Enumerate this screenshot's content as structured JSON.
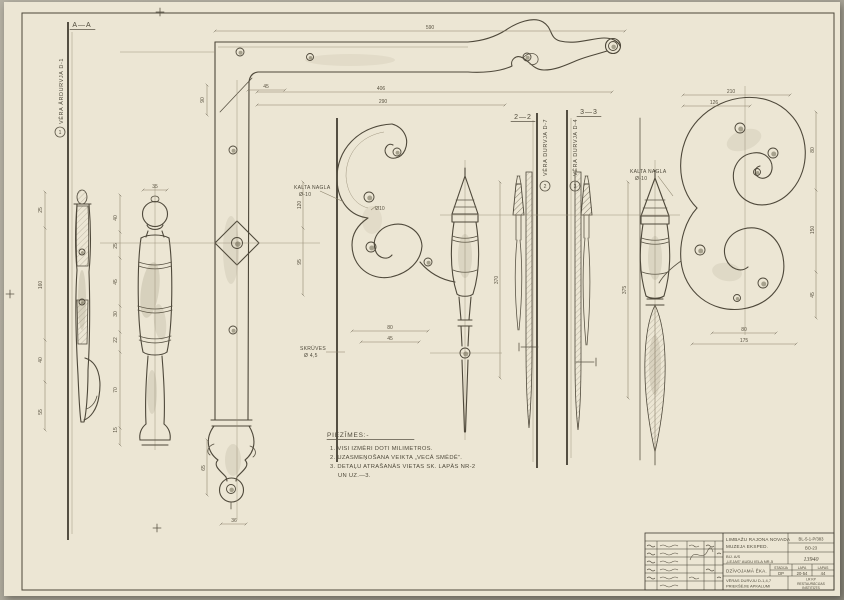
{
  "colors": {
    "paper": "#ece6d4",
    "background": "#a9a598",
    "pencil": "#4e483a",
    "pencil_light": "#8a8069"
  },
  "section_labels": {
    "left": "A—A",
    "mid": "2—2",
    "right": "3—3"
  },
  "vertical_labels": [
    {
      "no": "1",
      "text": "VĒRA ĀRDURVJA D-1"
    },
    {
      "no": "2",
      "text": "VĒRA DURVJA D-7"
    },
    {
      "no": "3",
      "text": "VĒRA DURVJA D-4"
    }
  ],
  "annotations": {
    "nail1_l1": "KALTA NAGLA",
    "nail1_l2": "Ø-10",
    "nail2_l1": "KALTA NAGLA",
    "nail2_l2": "Ø-10",
    "screws_l1": "SKRŪVES",
    "screws_l2": "Ø 4,5"
  },
  "notes": {
    "title": "PIEZĪMES:-",
    "lines": [
      "1. VISI IZMĒRI DOTI MILIMETROS.",
      "2. UZASMEŅOŠANA VEIKTA „VECĀ SMĒDĒ”.",
      "3. DETAĻU ATRAŠANĀS VIETAS SK. LAPĀS NR-2",
      "UN UZ.—3."
    ]
  },
  "dimensions": [
    {
      "v": "590",
      "x": 430,
      "y": 29,
      "r": 0
    },
    {
      "v": "406",
      "x": 381,
      "y": 90,
      "r": 0
    },
    {
      "v": "290",
      "x": 383,
      "y": 103,
      "r": 0
    },
    {
      "v": "45",
      "x": 266,
      "y": 88,
      "r": 0
    },
    {
      "v": "90",
      "x": 204,
      "y": 100,
      "r": -90
    },
    {
      "v": "210",
      "x": 731,
      "y": 93,
      "r": 0
    },
    {
      "v": "126",
      "x": 714,
      "y": 104,
      "r": 0
    },
    {
      "v": "80",
      "x": 814,
      "y": 150,
      "r": -90
    },
    {
      "v": "150",
      "x": 814,
      "y": 230,
      "r": -90
    },
    {
      "v": "45",
      "x": 814,
      "y": 295,
      "r": -90
    },
    {
      "v": "80",
      "x": 744,
      "y": 331,
      "r": 0
    },
    {
      "v": "175",
      "x": 744,
      "y": 342,
      "r": 0
    },
    {
      "v": "35",
      "x": 155,
      "y": 188,
      "r": 0
    },
    {
      "v": "40",
      "x": 117,
      "y": 218,
      "r": -90
    },
    {
      "v": "25",
      "x": 117,
      "y": 246,
      "r": -90
    },
    {
      "v": "45",
      "x": 117,
      "y": 282,
      "r": -90
    },
    {
      "v": "30",
      "x": 117,
      "y": 314,
      "r": -90
    },
    {
      "v": "22",
      "x": 117,
      "y": 340,
      "r": -90
    },
    {
      "v": "70",
      "x": 117,
      "y": 390,
      "r": -90
    },
    {
      "v": "15",
      "x": 117,
      "y": 430,
      "r": -90
    },
    {
      "v": "25",
      "x": 42,
      "y": 210,
      "r": -90
    },
    {
      "v": "160",
      "x": 42,
      "y": 285,
      "r": -90
    },
    {
      "v": "40",
      "x": 42,
      "y": 360,
      "r": -90
    },
    {
      "v": "55",
      "x": 42,
      "y": 412,
      "r": -90
    },
    {
      "v": "120",
      "x": 301,
      "y": 205,
      "r": -90
    },
    {
      "v": "95",
      "x": 301,
      "y": 262,
      "r": -90
    },
    {
      "v": "80",
      "x": 390,
      "y": 329,
      "r": 0
    },
    {
      "v": "45",
      "x": 390,
      "y": 340,
      "r": 0
    },
    {
      "v": "370",
      "x": 498,
      "y": 280,
      "r": -90
    },
    {
      "v": "375",
      "x": 626,
      "y": 290,
      "r": -90
    },
    {
      "v": "Ø10",
      "x": 380,
      "y": 210,
      "r": 0
    },
    {
      "v": "36",
      "x": 234,
      "y": 522,
      "r": 0
    },
    {
      "v": "65",
      "x": 205,
      "y": 468,
      "r": -90
    }
  ],
  "rivets": [
    {
      "x": 240,
      "y": 52,
      "r": 4
    },
    {
      "x": 310,
      "y": 57,
      "r": 3.5
    },
    {
      "x": 527,
      "y": 57,
      "r": 4
    },
    {
      "x": 613,
      "y": 46,
      "r": 4.5
    },
    {
      "x": 233,
      "y": 150,
      "r": 4
    },
    {
      "x": 233,
      "y": 330,
      "r": 4
    },
    {
      "x": 231,
      "y": 489,
      "r": 4.5
    },
    {
      "x": 237,
      "y": 243,
      "r": 5.5
    },
    {
      "x": 397,
      "y": 152,
      "r": 4
    },
    {
      "x": 369,
      "y": 197,
      "r": 5
    },
    {
      "x": 371,
      "y": 247,
      "r": 5
    },
    {
      "x": 428,
      "y": 262,
      "r": 4
    },
    {
      "x": 465,
      "y": 353,
      "r": 5
    },
    {
      "x": 740,
      "y": 128,
      "r": 5
    },
    {
      "x": 773,
      "y": 153,
      "r": 5
    },
    {
      "x": 757,
      "y": 172,
      "r": 3.5
    },
    {
      "x": 700,
      "y": 250,
      "r": 5
    },
    {
      "x": 763,
      "y": 283,
      "r": 5
    },
    {
      "x": 737,
      "y": 298,
      "r": 3.5
    },
    {
      "x": 82,
      "y": 252,
      "r": 3
    },
    {
      "x": 82,
      "y": 302,
      "r": 3
    }
  ],
  "titleblock": {
    "org_line1": "LIMBAŽU RAJONA NOVADA",
    "org_line2": "MUZEJA EKSPED.",
    "code_top": "BL-5-1-P/383",
    "code_bottom": "BO-23",
    "object_line1": "BIJ. A/S",
    "object_line2": "„LEJAS” AUDU IELA NR-5",
    "doc_no": "13940",
    "building": "DZĪVOJAMĀ ĒKA.",
    "stage_label": "STADIJA",
    "sheet_label": "LAPA",
    "sheets_label": "LAPAS",
    "stage": "DP",
    "sheet": "20-54",
    "sheets": "44",
    "subject_line1": "VĒRAS DURVJU D-1,4,7",
    "subject_line2": "PRIEKŠĒJIE APKALUMI",
    "inst_line1": "LR KP",
    "inst_line2": "RESTAURĀCIJAS",
    "inst_line3": "INSTITŪTS"
  }
}
